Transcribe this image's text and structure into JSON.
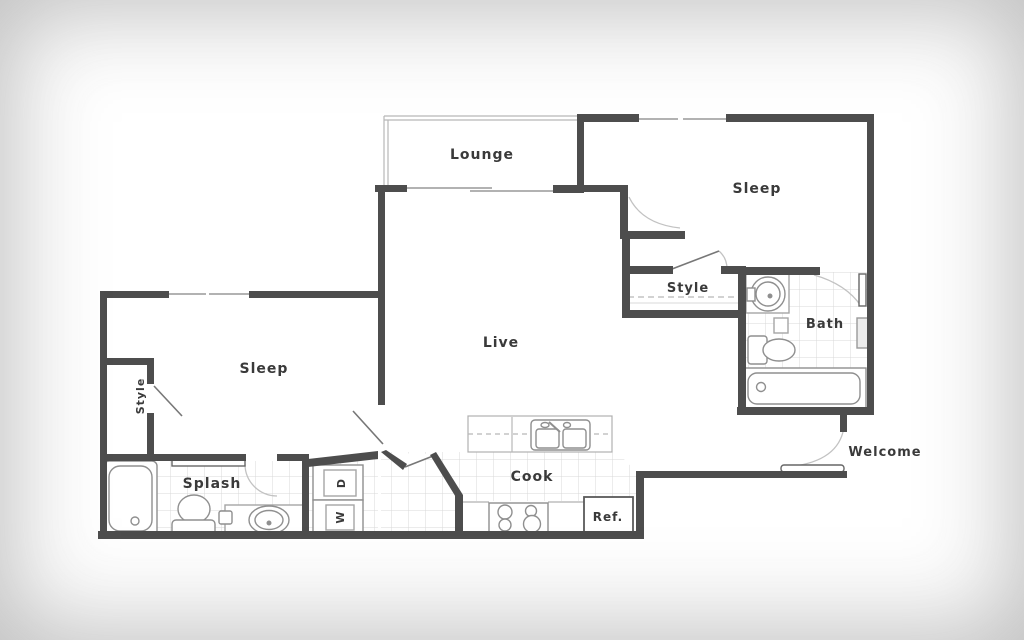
{
  "plan": {
    "rooms": {
      "lounge": "Lounge",
      "sleep_right": "Sleep",
      "sleep_left": "Sleep",
      "live": "Live",
      "style_right": "Style",
      "style_left": "Style",
      "bath": "Bath",
      "splash": "Splash",
      "cook": "Cook",
      "welcome": "Welcome"
    },
    "appliances": {
      "refrigerator": "Ref.",
      "dryer": "D",
      "washer": "W"
    }
  },
  "colors": {
    "wall": "#4d4d4d",
    "fixture": "#8f8f8f",
    "light_line": "#b8b8b8",
    "tile_line": "#d9d9d9",
    "label": "#3a3a3a",
    "background": "#ffffff"
  }
}
